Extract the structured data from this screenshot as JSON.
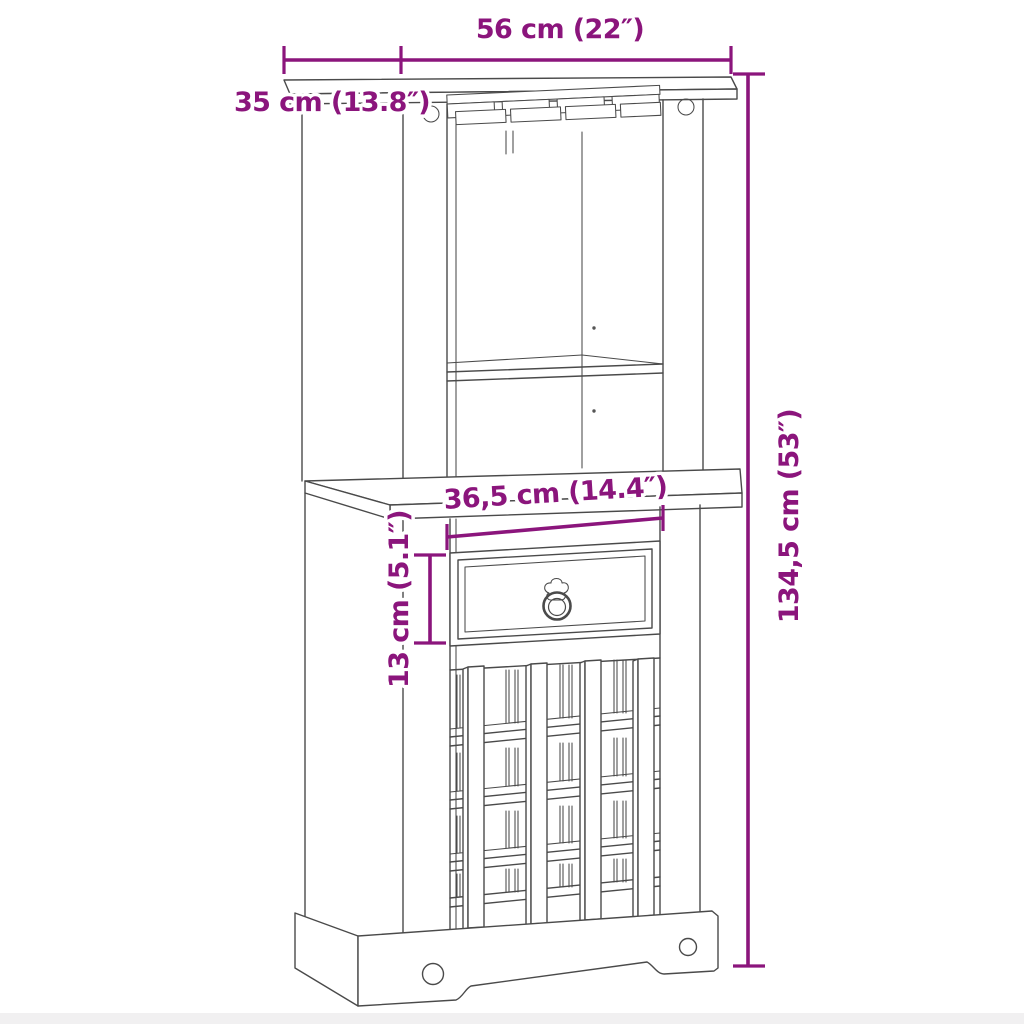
{
  "page": {
    "background": "#ffffff",
    "footer_strip_color": "#f1f0f1"
  },
  "diagram": {
    "type": "furniture-dimension-diagram",
    "subject": "bar-cabinet-with-wine-rack-and-glass-holder",
    "outline_color": "#4a4a4a",
    "dimension_color": "#8B157C",
    "dimensions": {
      "top_width": {
        "label": "56 cm (22″)",
        "value_cm": 56,
        "value_in": 22
      },
      "top_depth": {
        "label": "35 cm (13.8″)",
        "value_cm": 35,
        "value_in": 13.8
      },
      "drawer_width": {
        "label": "36,5 cm (14.4″)",
        "value_cm": 36.5,
        "value_in": 14.4
      },
      "drawer_height": {
        "label": "13 cm (5.1″)",
        "value_cm": 13,
        "value_in": 5.1
      },
      "total_height": {
        "label": "134,5 cm (53″)",
        "value_cm": 134.5,
        "value_in": 53
      }
    },
    "features": [
      "top-panel",
      "stemware-rack",
      "open-shelf-compartment",
      "middle-shelf",
      "shelf-pin-holes",
      "cam-lock-fittings",
      "drawer-with-ring-pull",
      "wine-bottle-lattice-rack",
      "plinth-base-with-arch-cutout"
    ]
  }
}
